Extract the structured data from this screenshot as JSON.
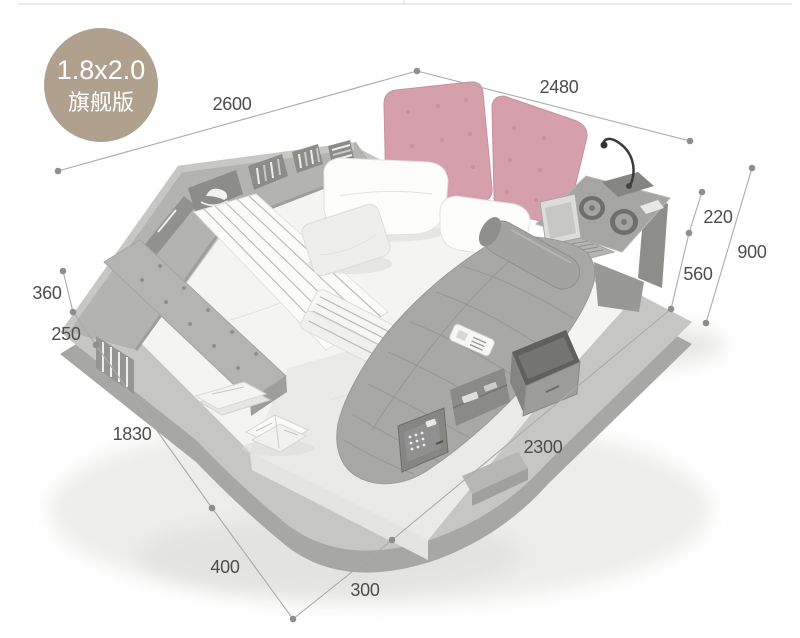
{
  "badge": {
    "size": "1.8x2.0",
    "edition": "旗舰版"
  },
  "dimensions": {
    "d2600": "2600",
    "d2480": "2480",
    "d220": "220",
    "d900": "900",
    "d560": "560",
    "d360": "360",
    "d250": "250",
    "d1830": "1830",
    "d400": "400",
    "d300": "300",
    "d2300": "2300"
  },
  "colors": {
    "badge_bg": "#b0a08e",
    "cushion_pink": "#d5a0ac",
    "dim_line": "#ababab",
    "dim_text": "#4d4d4d"
  }
}
